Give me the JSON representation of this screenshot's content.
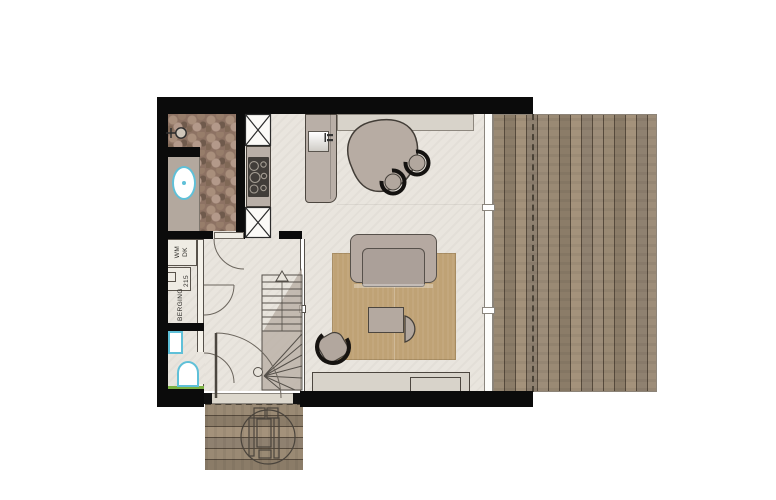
{
  "labels": {
    "washer": "WM",
    "dryer": "DK",
    "heat_pump": "WP",
    "storage": "BERGING",
    "dimension_215": "215"
  },
  "colors": {
    "wall": "#0b0b0b",
    "interior_floor": "#e9e5de",
    "stone_floor": "#8d7263",
    "wood_deck": "#978672",
    "rug": "#bfa275",
    "furniture_greige": "#b9afa7",
    "sanitary_accent": "#5fc0d8",
    "grass_accent": "#7cb244",
    "chair_ring": "#141210"
  }
}
